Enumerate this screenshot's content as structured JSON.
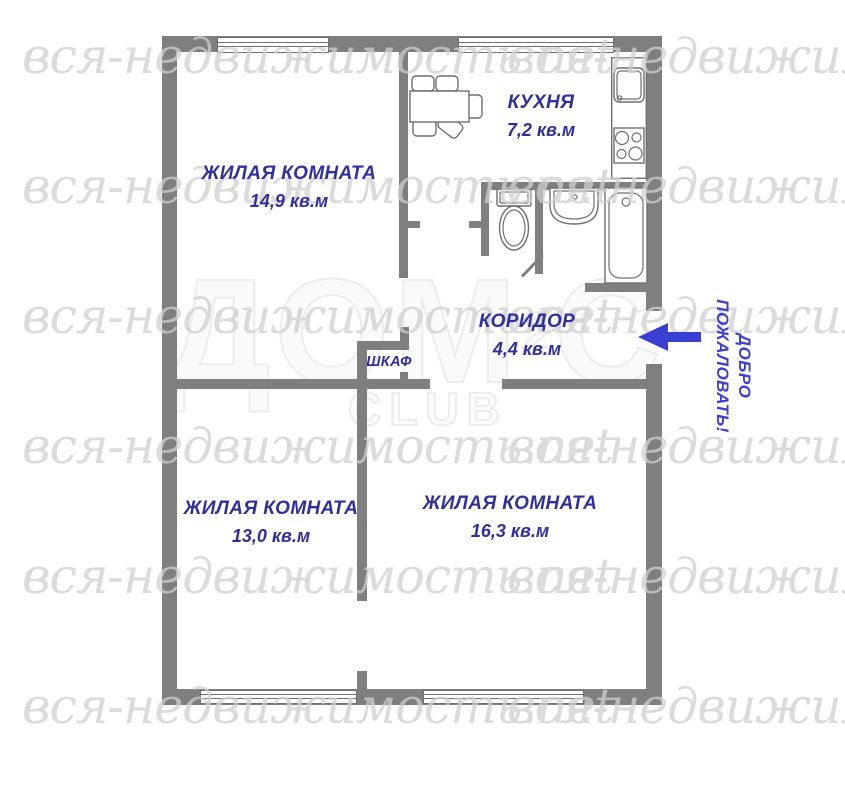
{
  "plan": {
    "rooms": [
      {
        "name": "ЖИЛАЯ КОМНАТА",
        "area": "14,9 кв.м"
      },
      {
        "name": "КУХНЯ",
        "area": "7,2 кв.м"
      },
      {
        "name": "КОРИДОР",
        "area": "4,4 кв.м"
      },
      {
        "name": "ШКАФ",
        "area": ""
      },
      {
        "name": "ЖИЛАЯ КОМНАТА",
        "area": "13,0 кв.м"
      },
      {
        "name": "ЖИЛАЯ КОМНАТА",
        "area": "16,3 кв.м"
      }
    ],
    "entrance": {
      "label": "ДОБРО\nПОЖАЛОВАТЬ!"
    },
    "watermark": {
      "script_text": "вся-недвижимость.net",
      "script_text_cut": "вся-недвижимост",
      "logo_main": "ДОМ",
      "logo_sup": "2",
      "logo_tail": "С",
      "logo_sub": "CLUB"
    },
    "colors": {
      "wall": "#7f7f7f",
      "fixture-line": "#6f6f6f",
      "label": "#2f2f9f",
      "arrow": "#3a3fd4",
      "welcome": "#3d3ed0",
      "watermark": "#cfcfcf",
      "logo": "#ececec"
    }
  }
}
